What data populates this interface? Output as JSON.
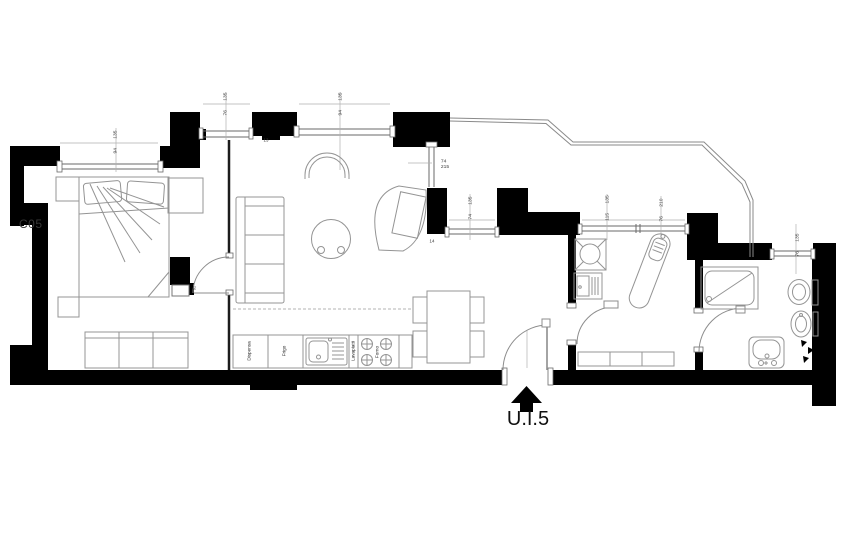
{
  "plan": {
    "block_label": "C05",
    "entrance_label": "U.I.5",
    "structure_marks": {
      "m13": "13",
      "m14": "14",
      "m92": "92"
    },
    "kitchen_labels": {
      "pantry": "Dispensa",
      "fridge": "Frigo",
      "dishwasher": "Lavapiatti",
      "oven": "Forno"
    },
    "window_dims": {
      "d1": {
        "w": "94",
        "h": "135"
      },
      "d2": {
        "w": "76",
        "h": "135"
      },
      "d3": {
        "w": "94",
        "h": "135"
      },
      "d4": {
        "w": "74",
        "h": "215"
      },
      "d5": {
        "w": "74",
        "h": "135"
      },
      "d6": {
        "w": "115",
        "h": "135"
      },
      "d7": {
        "w": "76",
        "h": "210"
      },
      "d8": {
        "w": "76",
        "h": "135"
      }
    },
    "colors": {
      "wall": "#000000",
      "furniture_line": "#8f8f8f",
      "dim_line": "#aaaaaa",
      "text": "#2f2f2f",
      "background": "#ffffff"
    }
  }
}
